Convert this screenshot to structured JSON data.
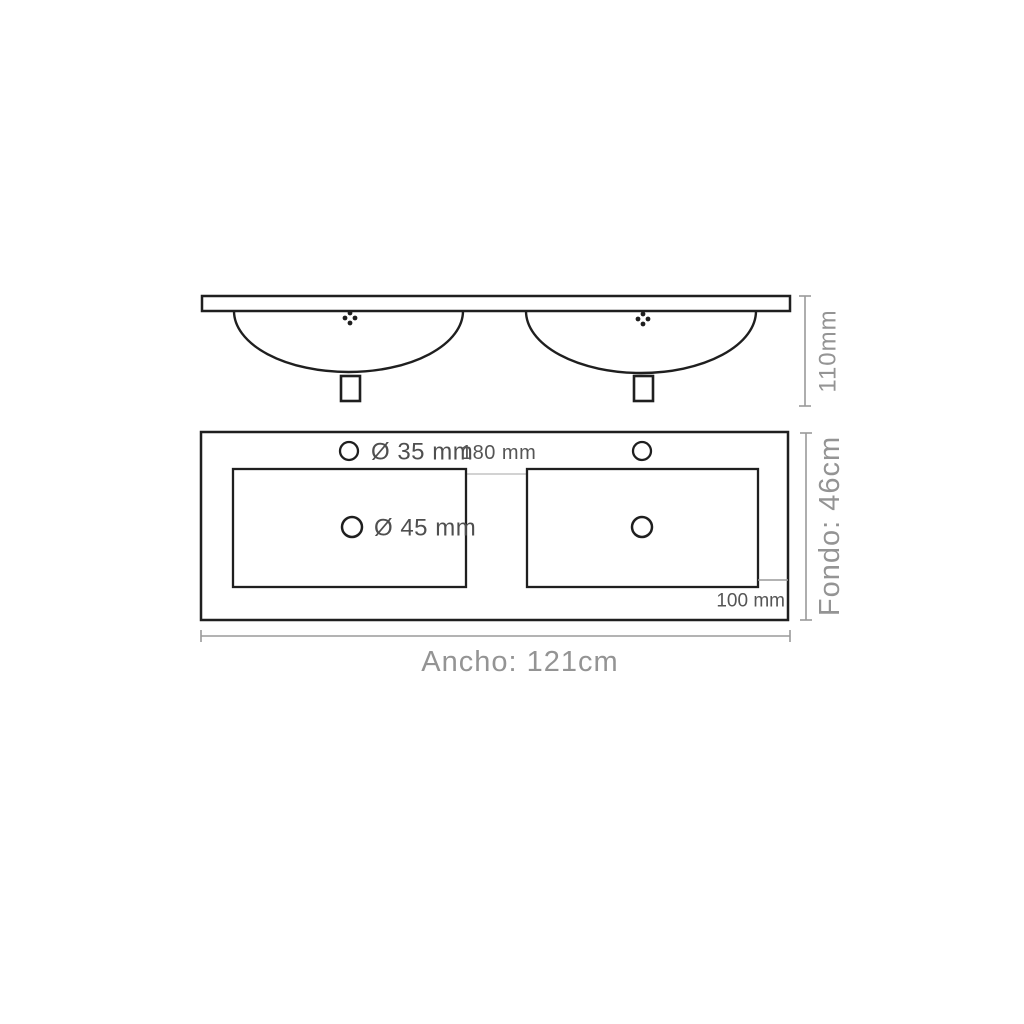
{
  "colors": {
    "background": "#ffffff",
    "drawing_line": "#1f1f1f",
    "dimension_line": "#9a9a9a",
    "light_divider": "#c4c4c4",
    "label_dark": "#4f4f4f",
    "label_dim": "#949494"
  },
  "side_view": {
    "height_label": "110mm"
  },
  "plan_view": {
    "faucet_hole_label": "Ø 35 mm",
    "basin_spacing_label": "180 mm",
    "drain_hole_label": "Ø 45 mm",
    "edge_offset_label": "100 mm",
    "depth_label": "Fondo: 46cm",
    "width_label": "Ancho: 121cm"
  }
}
